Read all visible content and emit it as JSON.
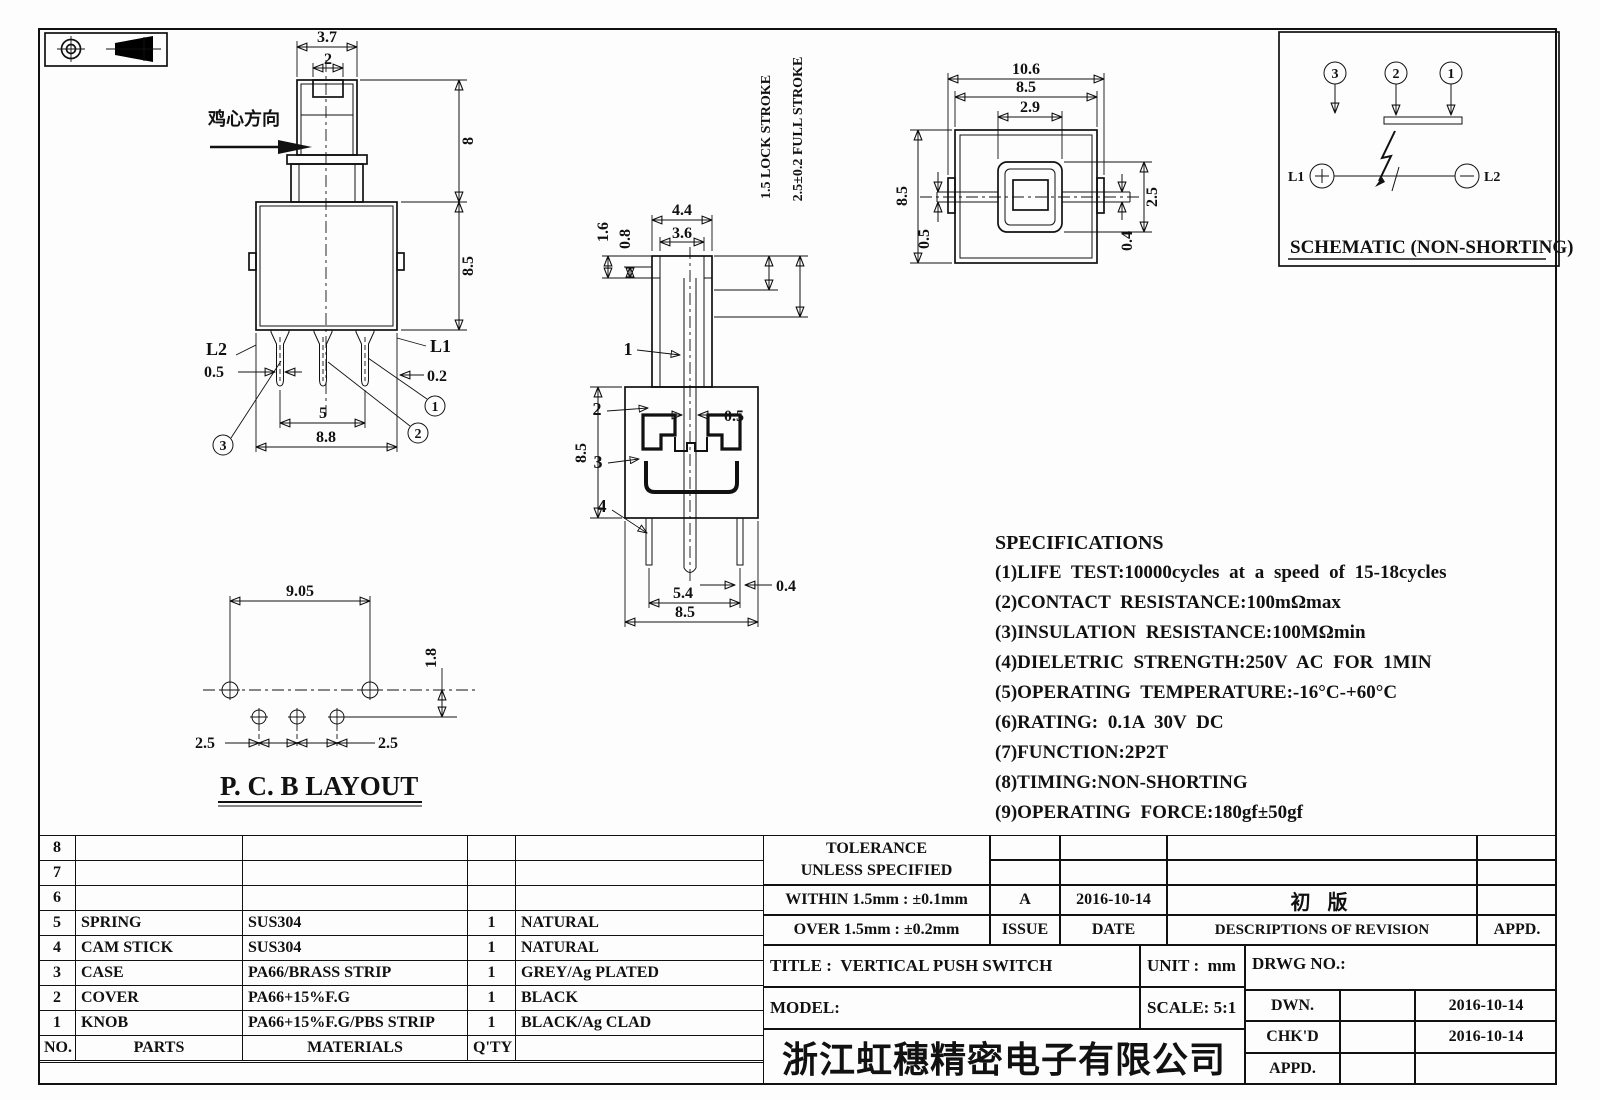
{
  "front_view": {
    "note": "鸡心方向",
    "dims": {
      "knob_w": "3.7",
      "knob_slot": "2",
      "knob_h": "8",
      "body_h": "8.5",
      "pin_w": "0.5",
      "wall": "0.2",
      "pin_span": "5",
      "body_w": "8.8"
    },
    "labels": {
      "l1": "L1",
      "l2": "L2",
      "p1": "1",
      "p2": "2",
      "p3": "3"
    }
  },
  "side_view": {
    "dims": {
      "step1": "1.6",
      "step2": "0.8",
      "shaft_w": "4.4",
      "shaft_inner": "3.6",
      "rod": "0.5",
      "body_h": "8.5",
      "pin_span": "5.4",
      "pin_w": "0.4",
      "body_w": "8.5"
    },
    "notes": {
      "lock": "1.5 LOCK STROKE",
      "full": "2.5±0.2 FULL STROKE"
    },
    "refs": {
      "r1": "1",
      "r2": "2",
      "r3": "3",
      "r4": "4"
    }
  },
  "top_view": {
    "dims": {
      "overall": "10.6",
      "body": "8.5",
      "knob": "2.9",
      "side": "8.5",
      "offset": "0.5",
      "knob_h": "2.5",
      "strip": "0.4"
    }
  },
  "schematic": {
    "caption": "SCHEMATIC (NON-SHORTING)",
    "pins": {
      "p1": "1",
      "p2": "2",
      "p3": "3"
    },
    "l1": "L1",
    "l2": "L2"
  },
  "pcb_layout": {
    "caption": "P. C. B  LAYOUT",
    "dims": {
      "span": "9.05",
      "row": "1.8",
      "left": "2.5",
      "right": "2.5"
    }
  },
  "specifications": {
    "title": "SPECIFICATIONS",
    "items": [
      "(1)LIFE TEST:10000cycles at a speed of 15-18cycles",
      "(2)CONTACT RESISTANCE:100mΩmax",
      "(3)INSULATION RESISTANCE:100MΩmin",
      "(4)DIELETRIC STRENGTH:250V AC FOR 1MIN",
      "(5)OPERATING TEMPERATURE:-16°C-+60°C",
      "(6)RATING: 0.1A 30V DC",
      "(7)FUNCTION:2P2T",
      "(8)TIMING:NON-SHORTING",
      "(9)OPERATING FORCE:180gf±50gf"
    ]
  },
  "parts_table": {
    "headers": {
      "no": "NO.",
      "parts": "PARTS",
      "materials": "MATERIALS",
      "qty": "Q'TY",
      "finish": ""
    },
    "rows": [
      {
        "no": "8",
        "parts": "",
        "materials": "",
        "qty": "",
        "finish": ""
      },
      {
        "no": "7",
        "parts": "",
        "materials": "",
        "qty": "",
        "finish": ""
      },
      {
        "no": "6",
        "parts": "",
        "materials": "",
        "qty": "",
        "finish": ""
      },
      {
        "no": "5",
        "parts": "SPRING",
        "materials": "SUS304",
        "qty": "1",
        "finish": "NATURAL"
      },
      {
        "no": "4",
        "parts": "CAM STICK",
        "materials": "SUS304",
        "qty": "1",
        "finish": "NATURAL"
      },
      {
        "no": "3",
        "parts": "CASE",
        "materials": "PA66/BRASS STRIP",
        "qty": "1",
        "finish": "GREY/Ag PLATED"
      },
      {
        "no": "2",
        "parts": "COVER",
        "materials": "PA66+15%F.G",
        "qty": "1",
        "finish": "BLACK"
      },
      {
        "no": "1",
        "parts": "KNOB",
        "materials": "PA66+15%F.G/PBS STRIP",
        "qty": "1",
        "finish": "BLACK/Ag CLAD"
      }
    ]
  },
  "revision_block": {
    "tolerance_title": "TOLERANCE",
    "tolerance_sub": "UNLESS  SPECIFIED",
    "within": "WITHIN 1.5mm : ±0.1mm",
    "over": "OVER 1.5mm : ±0.2mm",
    "issue_value": "A",
    "date_value": "2016-10-14",
    "revision_desc": "初  版",
    "issue_label": "ISSUE",
    "date_label": "DATE",
    "desc_label": "DESCRIPTIONS OF REVISION",
    "appd_label": "APPD."
  },
  "title_block": {
    "title_label": "TITLE :",
    "title": "VERTICAL PUSH SWITCH",
    "unit_label": "UNIT :",
    "unit": "mm",
    "model_label": "MODEL:",
    "scale_label": "SCALE:",
    "scale": "5:1",
    "drwg_label": "DRWG NO.:",
    "dwn_label": "DWN.",
    "chkd_label": "CHK'D",
    "appd_label": "APPD.",
    "dwn_date": "2016-10-14",
    "chkd_date": "2016-10-14",
    "company": "浙江虹穗精密电子有限公司"
  }
}
